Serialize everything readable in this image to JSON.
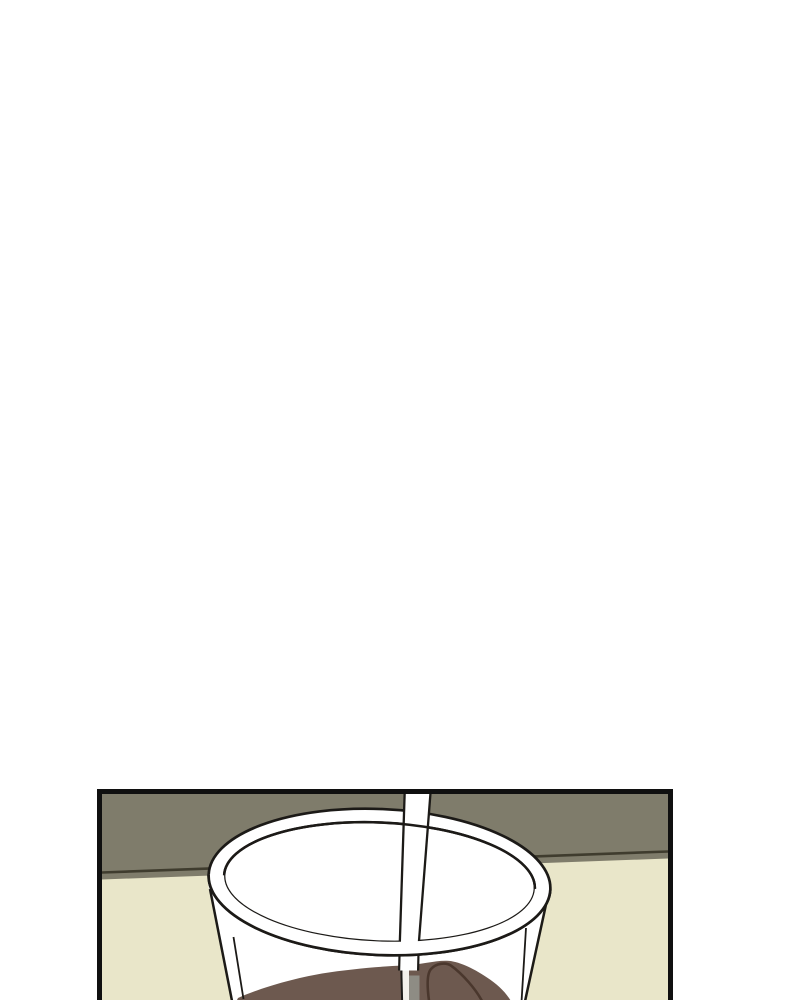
{
  "scene": {
    "type": "comic-panel",
    "description": "Webtoon panel, bottom-cropped: a clear plastic cup of iced coffee with a straw standing on a pale table in front of an olive wall. The area above the panel is blank white."
  },
  "colors": {
    "page_background": "#ffffff",
    "panel_border": "#101010",
    "outline": "#1c1a17",
    "wall": "#7f7c6b",
    "wall_edge_line": "#3f3c2e",
    "table": "#e9e6c9",
    "cup_white": "#ffffff",
    "liquid": "#6d594f",
    "swirl": "#4a372d",
    "straw_submerged": "#8e8c84",
    "straw_highlight": "#f2f0ea"
  }
}
